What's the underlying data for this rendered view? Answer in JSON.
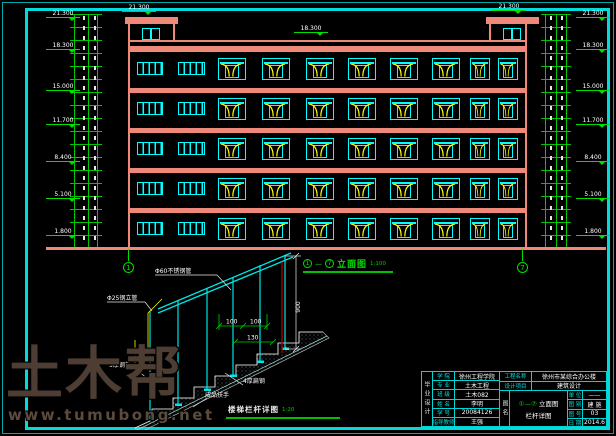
{
  "colors": {
    "background": "#000000",
    "frame": "#00dcdc",
    "wall": "#ee8878",
    "window": "#00ffff",
    "swing": "#ffff00",
    "dimension": "#00e000",
    "text": "#ffffff",
    "section_line": "#aa0000",
    "watermark": "#4d3d33"
  },
  "elevation": {
    "caption": {
      "axis_start": "1",
      "axis_end": "7",
      "title": "立面图",
      "scale": "1:100"
    },
    "levels_left": [
      "21.300",
      "18.300",
      "15.000",
      "11.700",
      "8.400",
      "5.100",
      "1.800"
    ],
    "levels_right": [
      "21.300",
      "18.300",
      "15.000",
      "11.700",
      "8.400",
      "5.100",
      "1.800"
    ],
    "bulkhead_left_level": "21.300",
    "bulkhead_right_level": "21.300",
    "roof_level": "18.300",
    "floors": 5,
    "axis_bubbles": [
      "1",
      "7"
    ],
    "window_columns": [
      {
        "type": "plain",
        "x": 9,
        "w": 26
      },
      {
        "type": "plain",
        "x": 50,
        "w": 27
      },
      {
        "type": "unit",
        "x": 90,
        "w": 28
      },
      {
        "type": "unit",
        "x": 134,
        "w": 28
      },
      {
        "type": "unit",
        "x": 178,
        "w": 28
      },
      {
        "type": "unit",
        "x": 220,
        "w": 28
      },
      {
        "type": "unit",
        "x": 262,
        "w": 28
      },
      {
        "type": "unit",
        "x": 304,
        "w": 28
      },
      {
        "type": "unit",
        "x": 342,
        "w": 20
      },
      {
        "type": "unit",
        "x": 370,
        "w": 20
      }
    ]
  },
  "stair_detail": {
    "caption": {
      "title": "楼梯栏杆详图",
      "scale": "1:20"
    },
    "labels": {
      "rail": "Φ60不锈钢管",
      "post": "Φ25钢立管",
      "plate": "5厚钢板",
      "flat_steel": "4厚扁钢",
      "handrail": "成品扶手"
    },
    "dims": {
      "height": "900",
      "a": "100",
      "b": "100",
      "c": "130"
    }
  },
  "title_block": {
    "side_label": "毕业设计",
    "left_rows": [
      {
        "label": "学 院",
        "value": "徐州工程学院"
      },
      {
        "label": "专 业",
        "value": "土木工程"
      },
      {
        "label": "班 级",
        "value": "土木082"
      },
      {
        "label": "姓 名",
        "value": "李明"
      },
      {
        "label": "学 号",
        "value": "20084126"
      },
      {
        "label": "指导教师",
        "value": "王强"
      }
    ],
    "project_rows": [
      {
        "label": "工程名称",
        "value": "徐州市某综合办公楼"
      },
      {
        "label": "设计项目",
        "value": "建筑设计"
      }
    ],
    "drawing_name_label": "图名",
    "drawing_name": {
      "prefix": "①—⑦",
      "line1": "立面图",
      "line2": "栏杆详图"
    },
    "right_rows": [
      {
        "label": "单 位",
        "value": "——"
      },
      {
        "label": "图 别",
        "value": "建 施"
      },
      {
        "label": "图 号",
        "value": "03"
      },
      {
        "label": "日 期",
        "value": "2014.6"
      }
    ]
  },
  "watermark": {
    "logo": "土木帮",
    "url": "www.tumubong.net"
  }
}
